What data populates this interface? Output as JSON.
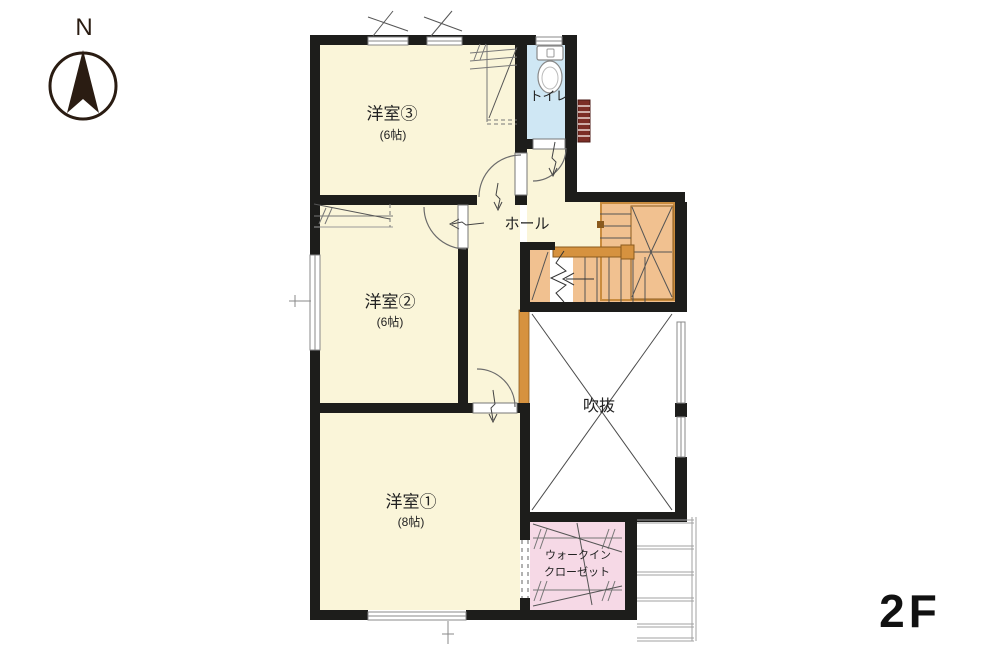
{
  "floor_indicator": "2F",
  "compass": {
    "north_label": "N"
  },
  "rooms": {
    "room3": {
      "name": "洋室③",
      "size": "(6帖)"
    },
    "room2": {
      "name": "洋室②",
      "size": "(6帖)"
    },
    "room1": {
      "name": "洋室①",
      "size": "(8帖)"
    },
    "toilet": {
      "name": "トイレ"
    },
    "hall": {
      "name": "ホール"
    },
    "void": {
      "name": "吹抜"
    },
    "wic": {
      "name_line1": "ウォークイン",
      "name_line2": "クローゼット"
    }
  },
  "colors": {
    "wall": "#1d1d1b",
    "room_cream": "#faf5d9",
    "toilet_blue": "#cfe7f4",
    "closet_pink": "#f6d9e6",
    "stair_orange": "#f1c190",
    "wood_orange": "#d6923f",
    "roof_gray": "#a0a0a0",
    "vent_red": "#7c2e26",
    "void_white": "#ffffff"
  }
}
